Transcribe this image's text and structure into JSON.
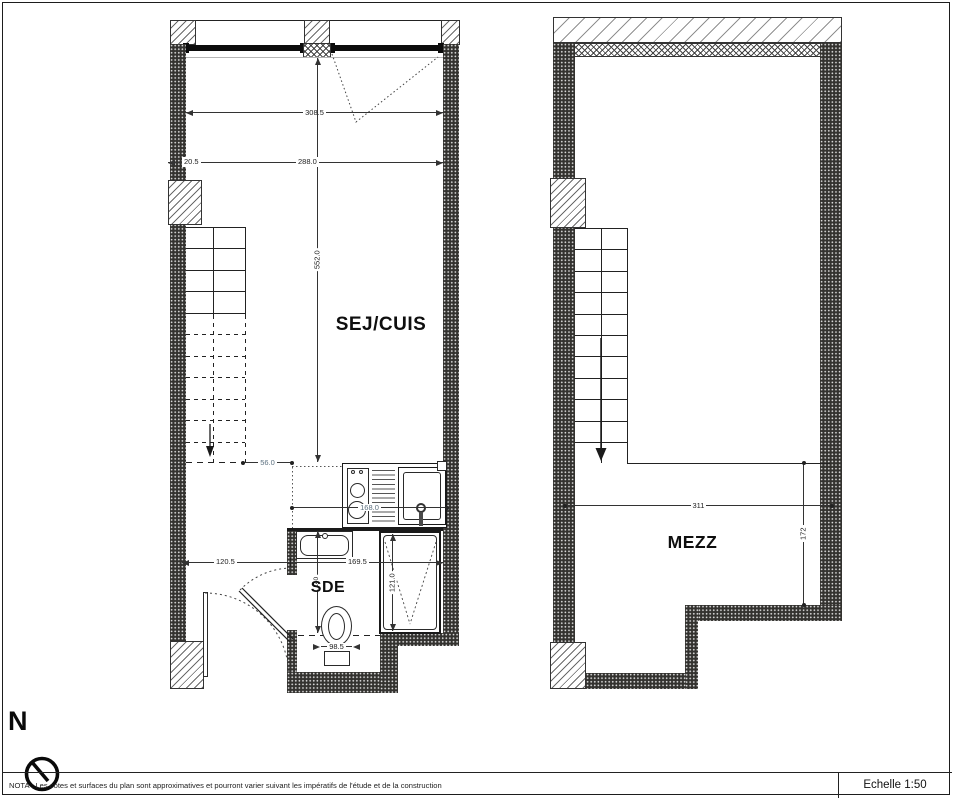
{
  "left_plan": {
    "room_label": "SEJ/CUIS",
    "bath_label": "SDE",
    "dim_total_width": "308.5",
    "dim_wall": "20.5",
    "dim_inner_width": "288.0",
    "dim_room_length": "552.0",
    "dim_mezz_edge": "56.0",
    "dim_kitchen": "168.0",
    "dim_hall": "120.5",
    "dim_bath_width": "169.5",
    "dim_shower": "121.0",
    "dim_wc": "98.5",
    "dim_bath_depth": "140"
  },
  "right_plan": {
    "room_label": "MEZZ",
    "dim_width": "311",
    "dim_depth": "172"
  },
  "compass": {
    "north_label": "N"
  },
  "footer": {
    "nota": "NOTA : Les cotes et surfaces du plan sont approximatives et pourront varier suivant les impératifs de l'étude et de la construction",
    "scale_label": "Echelle 1:50"
  },
  "colors": {
    "ink": "#1a1a1a",
    "dim_alt": "#5d7180"
  }
}
